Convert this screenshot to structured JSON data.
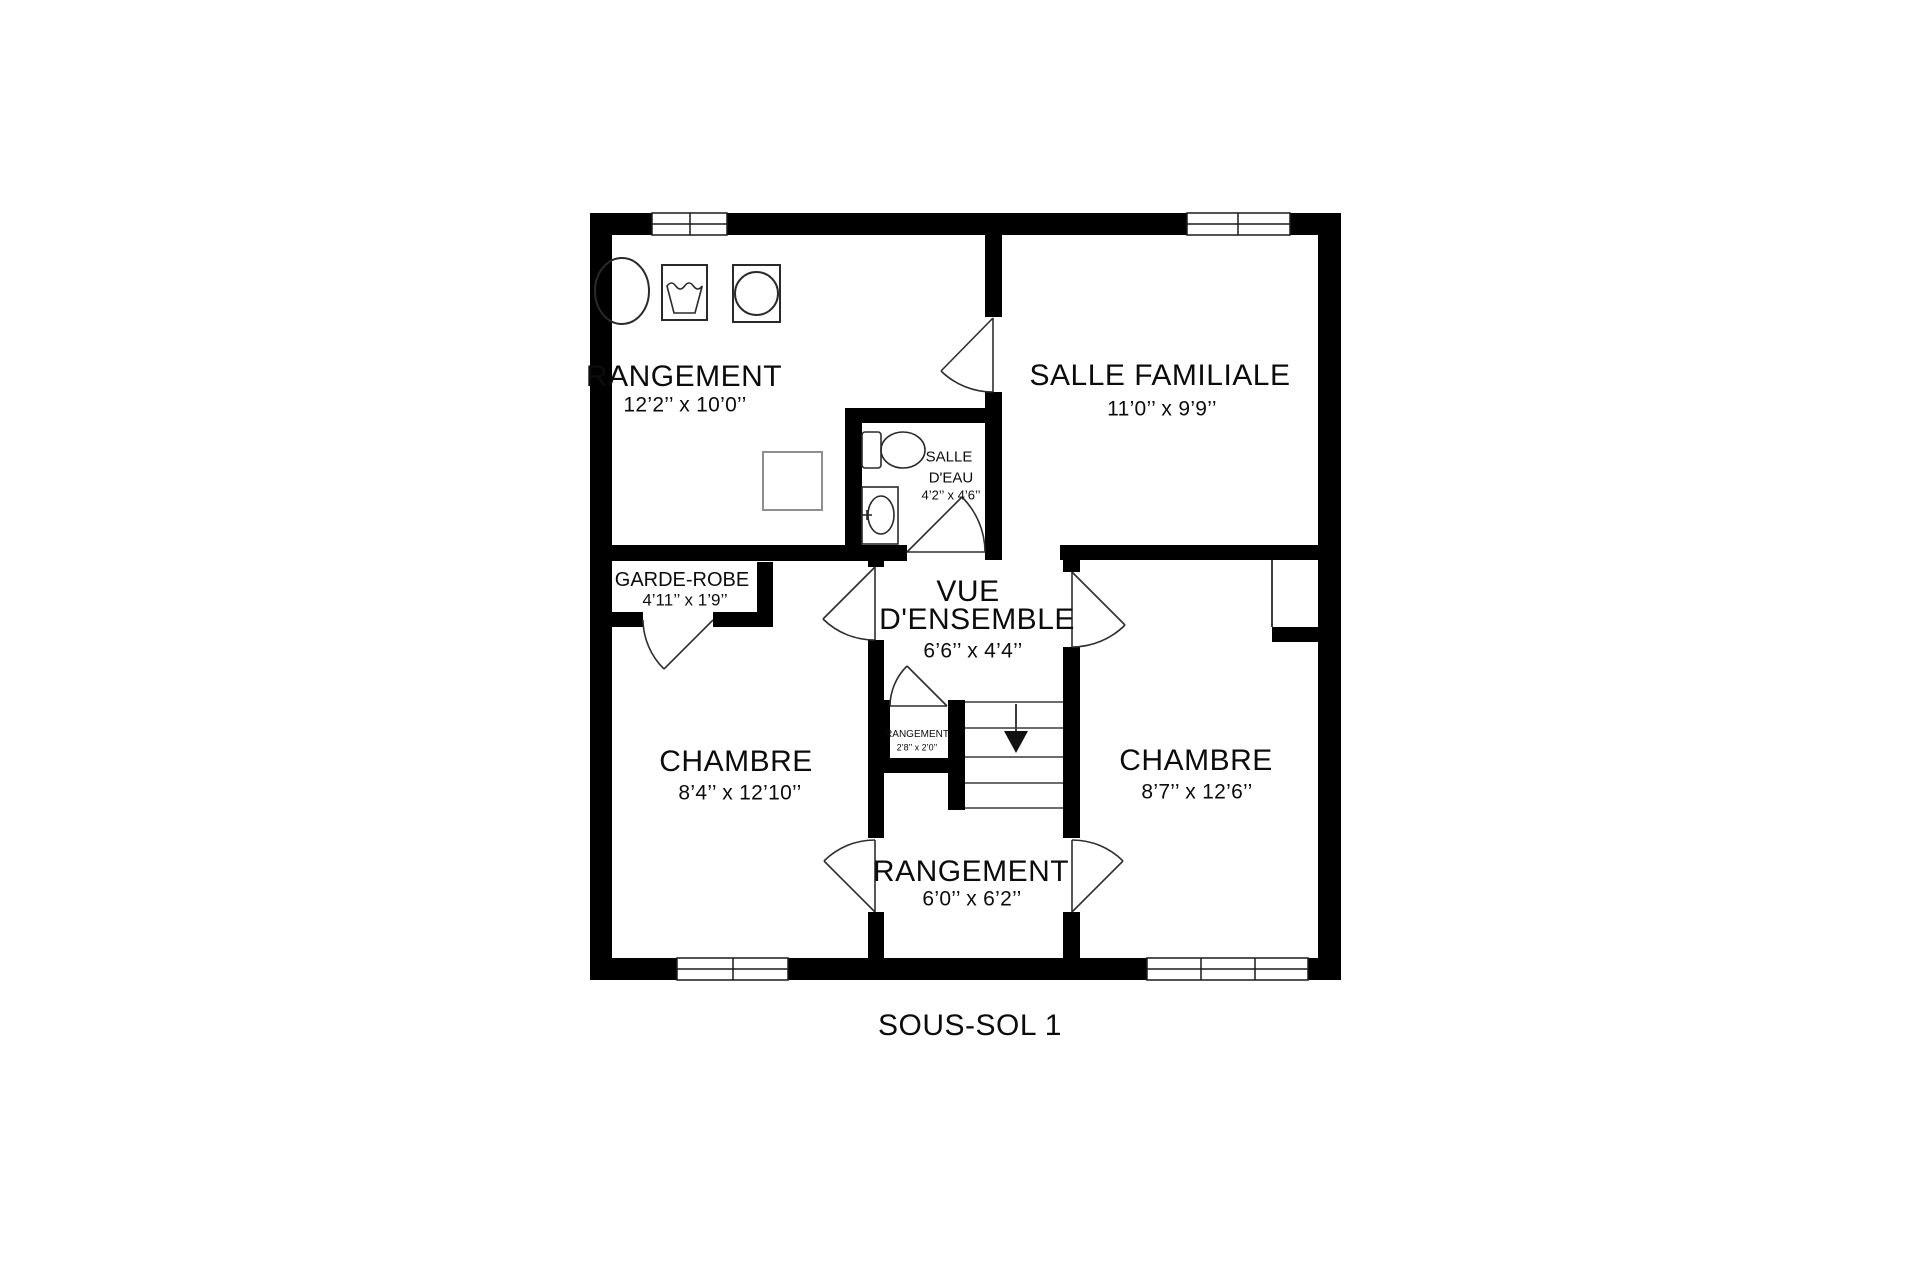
{
  "floor_label": "SOUS-SOL 1",
  "colors": {
    "background": "#ffffff",
    "wall": "#000000",
    "text": "#0c0c0c",
    "door_stroke": "#2e2e2e",
    "stair_stroke": "#3c3c3c",
    "fixture_stroke": "#2a2a2a",
    "furnace_stroke": "#8f8f8f",
    "window_stroke": "#1a1a1a"
  },
  "rooms": {
    "rangement_top": {
      "name": "RANGEMENT",
      "dims": "12’2’’ x 10’0’’"
    },
    "salle_familiale": {
      "name": "SALLE FAMILIALE",
      "dims": "11’0’’ x 9’9’’"
    },
    "salle_eau": {
      "name_line1": "SALLE",
      "name_line2": "D'EAU",
      "dims": "4’2’’ x 4’6’’"
    },
    "garde_robe": {
      "name": "GARDE-ROBE",
      "dims": "4’11’’ x 1’9’’"
    },
    "vue_densemble": {
      "name_line1": "VUE",
      "name_line2": "D'ENSEMBLE",
      "dims": "6’6’’ x 4’4’’"
    },
    "rangement_closet": {
      "name": "RANGEMENT",
      "dims": "2’8’’ x 2’0’’"
    },
    "chambre_left": {
      "name": "CHAMBRE",
      "dims": "8’4’’ x 12’10’’"
    },
    "chambre_right": {
      "name": "CHAMBRE",
      "dims": "8’7’’ x 12’6’’"
    },
    "rangement_bottom": {
      "name": "RANGEMENT",
      "dims": "6’0’’ x 6’2’’"
    }
  },
  "fixtures": [
    "washing-machine",
    "laundry-tub",
    "dryer",
    "furnace",
    "toilet",
    "sink",
    "stairs-down"
  ]
}
